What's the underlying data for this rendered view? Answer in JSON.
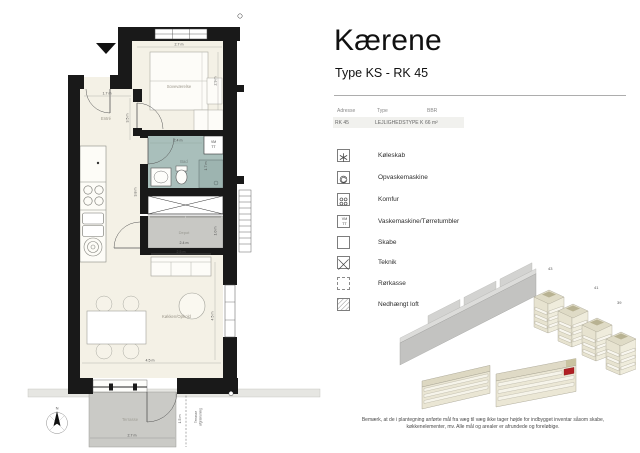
{
  "header": {
    "title": "Kærene",
    "subtitle": "Type KS - RK 45"
  },
  "info_table": {
    "headers": [
      "Adresse",
      "Type",
      "BBR"
    ],
    "row": {
      "adresse": "RK 45",
      "type": "LEJLIGHEDSTYPE K",
      "bbr": "66 m²"
    }
  },
  "legend": {
    "items": [
      {
        "label": "Køleskab",
        "icon": "fridge-snowflake-icon"
      },
      {
        "label": "Opvaskemaskine",
        "icon": "dishwasher-icon"
      },
      {
        "label": "Komfur",
        "icon": "stove-burners-icon"
      },
      {
        "label": "Vaskemaskine/Tørretumbler",
        "icon": "washer-dryer-icon",
        "icon_text_top": "VM",
        "icon_text_bottom": "TT"
      },
      {
        "label": "Skabe",
        "icon": "cabinet-box-icon"
      },
      {
        "label": "Teknik",
        "icon": "crossed-box-icon"
      },
      {
        "label": "Rørkasse",
        "icon": "dashed-box-icon"
      },
      {
        "label": "Nedhængt loft",
        "icon": "hatched-box-icon"
      }
    ]
  },
  "floor_plan": {
    "rooms": {
      "bedroom": "Soveværelse",
      "entry": "Entré",
      "bathroom": "Bad",
      "storage": "Depot",
      "living": "Køkken/Ophold",
      "terrace": "Terrasse"
    },
    "dimensions": {
      "bedroom_width": "2.7 m",
      "bedroom_depth": "2.9 m",
      "entry_width": "1.7 m",
      "entry_depth": "3.5 m",
      "bathroom_width": "2.4 m",
      "bathroom_depth": "1.7 m",
      "corridor_length": "3.8 m",
      "storage_width": "2.4 m",
      "storage_depth": "1.0 m",
      "sofa_width": "2.5 m",
      "living_width": "4.5 m",
      "living_depth": "4.5 m",
      "terrace_width": "2.7 m",
      "terrace_depth": "1.5 m"
    },
    "annotations": {
      "washer_vm": "VM",
      "washer_tt": "TT",
      "terrace_boundary_1": "Terrasse",
      "terrace_boundary_2": "afgrænsning",
      "compass_north": "N"
    }
  },
  "site_plan": {
    "building_labels": [
      "43",
      "41",
      "39"
    ],
    "highlight_color": "#b01f24"
  },
  "disclaimer": {
    "line1": "Bemærk, at de i plantegning anførte mål fra væg til væg ikke tager højde for indbygget inventar såsom skabe,",
    "line2": "køkkenelementer, mv. Alle mål og arealer er afrundede og foreløbige."
  }
}
